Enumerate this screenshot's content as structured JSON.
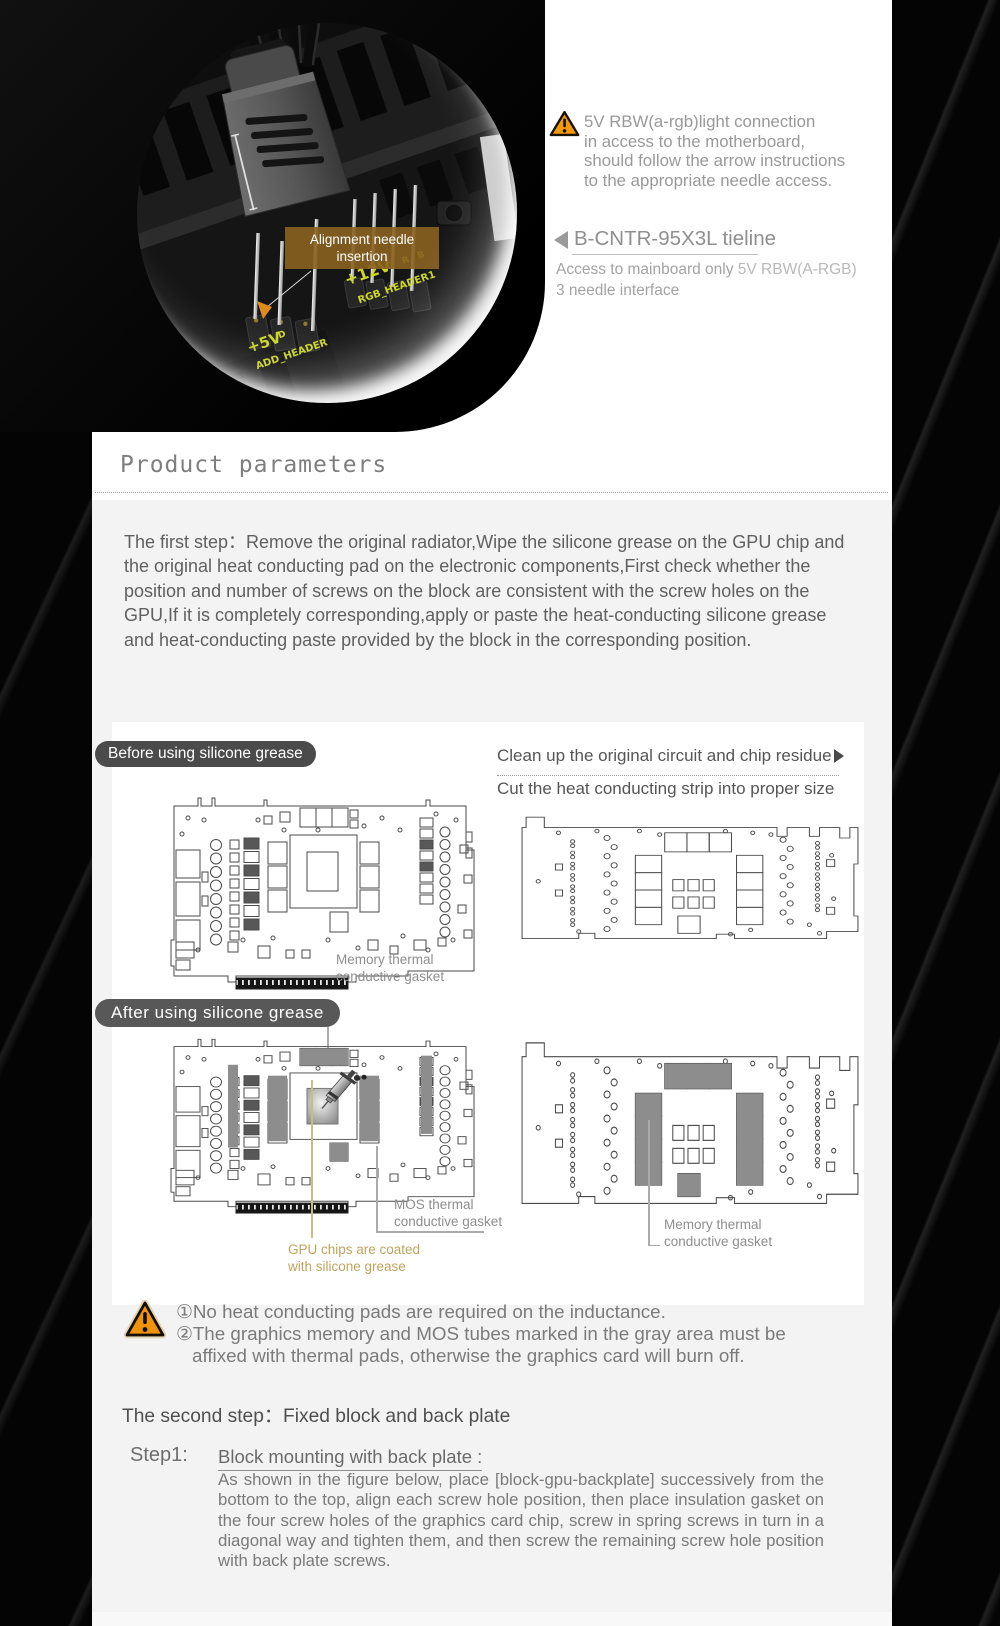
{
  "photo": {
    "callout": {
      "line1": "Alignment needle",
      "line2": "insertion"
    },
    "silk_left_volt": "+5V",
    "silk_left_pin": "D",
    "silk_left_name": "ADD_HEADER",
    "silk_right_volt": "+12V",
    "silk_right_pins": "G R B",
    "silk_right_name": "RGB_HEADER1"
  },
  "top_note": {
    "line1": "5V RBW(a-rgb)light connection",
    "line2": "in access to the motherboard,",
    "line3": "should follow the arrow instructions",
    "line4": "to the appropriate needle access."
  },
  "tieline": {
    "title": "B-CNTR-95X3L tieline",
    "sub_plain": "Access to mainboard only ",
    "sub_highlight": "5V RBW(A-RGB)",
    "sub_line2": "3 needle interface"
  },
  "section_header": {
    "title": "Product parameters"
  },
  "first_step": {
    "paragraph": "The first step：Remove the original radiator,Wipe the silicone grease on the GPU chip and the original heat conducting pad on the electronic components,First check whether the position and number of screws on the block are consistent with the screw holes on the GPU,If it is completely corresponding,apply or paste the heat-conducting silicone grease and heat-conducting paste provided by the block in the corresponding position."
  },
  "diagram_panel": {
    "badge_before": "Before using silicone grease",
    "badge_after": "After using silicone grease",
    "tip_line1": "Clean up the original circuit and chip residue",
    "tip_line2": "Cut the heat conducting strip into proper size",
    "label_memory_top_1": "Memory thermal",
    "label_memory_top_2": "conductive gasket",
    "label_mos_1": "MOS thermal",
    "label_mos_2": "conductive gasket",
    "label_gpu_1": "GPU chips are coated",
    "label_gpu_2": "with silicone grease",
    "label_memory_right_1": "Memory thermal",
    "label_memory_right_2": "conductive gasket"
  },
  "notes": {
    "line1": "①No heat conducting pads are required on the inductance.",
    "line2": "②The graphics memory and MOS tubes marked in the gray area must be",
    "line3": "affixed with thermal pads, otherwise the graphics card will burn off."
  },
  "second_step": {
    "title": "The second step：Fixed block and back plate",
    "step_label": "Step1:",
    "subtitle": "Block mounting with back plate : ",
    "body": "As shown in the figure below, place [block-gpu-backplate] successively from the bottom to the top, align each screw hole position, then place insulation gasket on the four screw holes of the graphics card chip, screw in spring screws in turn in a diagonal way and tighten them, and then screw the remaining screw hole position with back plate screws."
  },
  "colors": {
    "accent_orange": "#f49a0a",
    "silkscreen_yellow": "#cdd827",
    "annotation_tan": "#bfa45e"
  }
}
